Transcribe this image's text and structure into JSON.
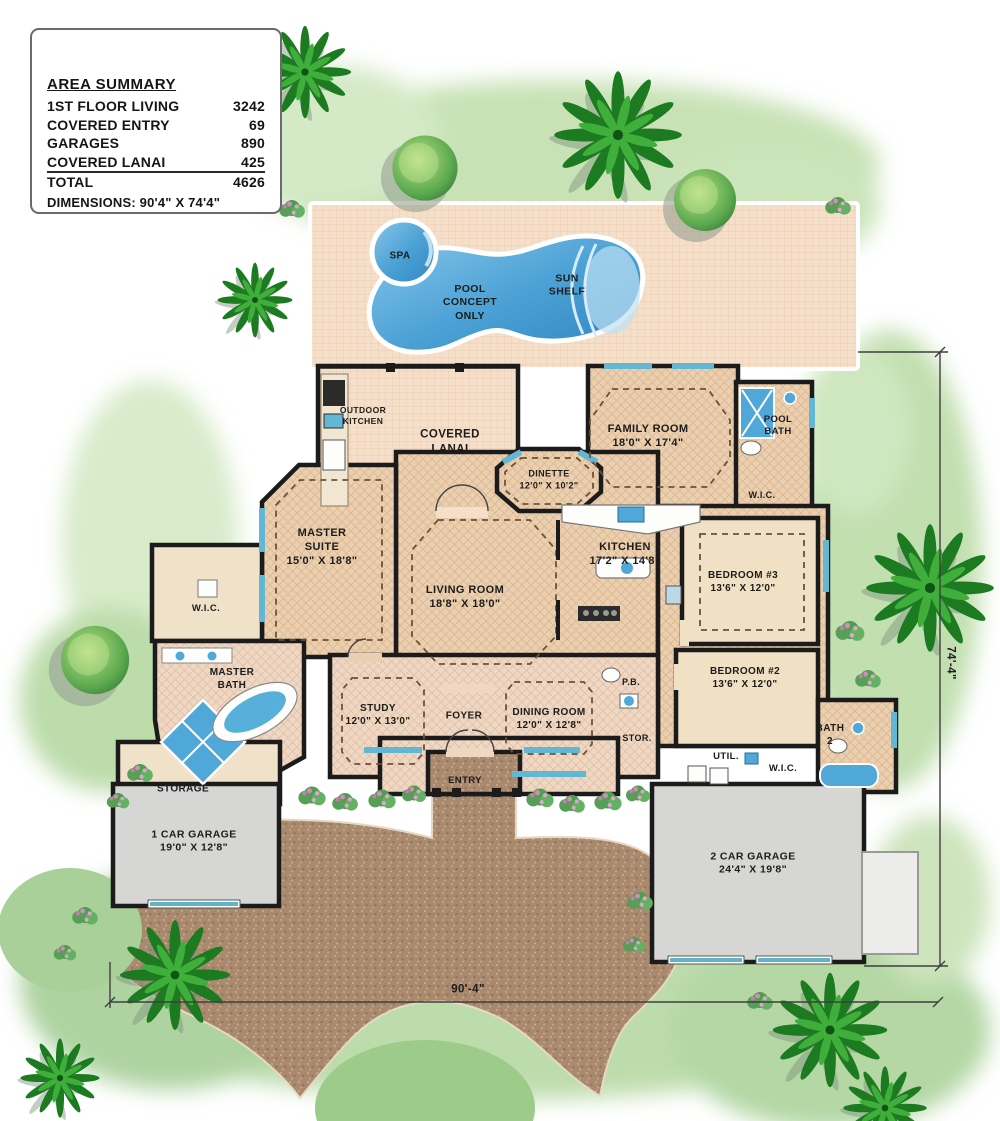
{
  "area_summary": {
    "title": "AREA SUMMARY",
    "rows": [
      {
        "label": "1ST FLOOR LIVING",
        "value": "3242"
      },
      {
        "label": "COVERED ENTRY",
        "value": "69"
      },
      {
        "label": "GARAGES",
        "value": "890"
      },
      {
        "label": "COVERED LANAI",
        "value": "425"
      },
      {
        "label": "TOTAL",
        "value": "4626"
      }
    ],
    "dimensions_note": "DIMENSIONS: 90'4\" X 74'4\""
  },
  "pool_area": {
    "spa": "SPA",
    "pool_note": "POOL\nCONCEPT\nONLY",
    "sun_shelf": "SUN\nSHELF"
  },
  "rooms": {
    "outdoor_kitchen": "OUTDOOR\nKITCHEN",
    "covered_lanai": "COVERED\nLANAI",
    "dinette": "DINETTE\n12'0\" X 10'2\"",
    "family_room": "FAMILY ROOM\n18'0\" X 17'4\"",
    "pool_bath": "POOL\nBATH",
    "wic_pool_bath": "W.I.C.",
    "master_suite": "MASTER\nSUITE\n15'0\" X 18'8\"",
    "living_room": "LIVING ROOM\n18'8\" X 18'0\"",
    "kitchen": "KITCHEN\n17'2\" X 14'8\"",
    "bedroom_3": "BEDROOM #3\n13'6\" X 12'0\"",
    "bedroom_2": "BEDROOM #2\n13'6\" X 12'0\"",
    "wic_master": "W.I.C.",
    "master_bath": "MASTER\nBATH",
    "study": "STUDY\n12'0\" X 13'0\"",
    "foyer": "FOYER",
    "dining_room": "DINING ROOM\n12'0\" X 12'8\"",
    "powder_bath": "P.B.",
    "storage_closet": "STOR.",
    "utility": "UTIL.",
    "wic_bedroom_2": "W.I.C.",
    "bath_2": "BATH\n2",
    "garage_storage": "STORAGE",
    "one_car_garage": "1 CAR GARAGE\n19'0\" X 12'8\"",
    "two_car_garage": "2 CAR GARAGE\n24'4\" X 19'8\"",
    "entry": "ENTRY"
  },
  "plot_dimensions": {
    "width": "90'-4\"",
    "height": "74'-4\""
  },
  "colors": {
    "pool_water": "#4da3d6",
    "pool_deck": "#f6dfc9",
    "floor_tan": "#ead0b0",
    "wall_black": "#1b1b1b",
    "garage_gray": "#d6d6d4",
    "driveway_brown": "#a98a6e",
    "lawn_green": "#bfdcab",
    "palm_green": "#1c7a21",
    "flower_pink": "#d989c0",
    "window_blue": "#62b7d4"
  }
}
